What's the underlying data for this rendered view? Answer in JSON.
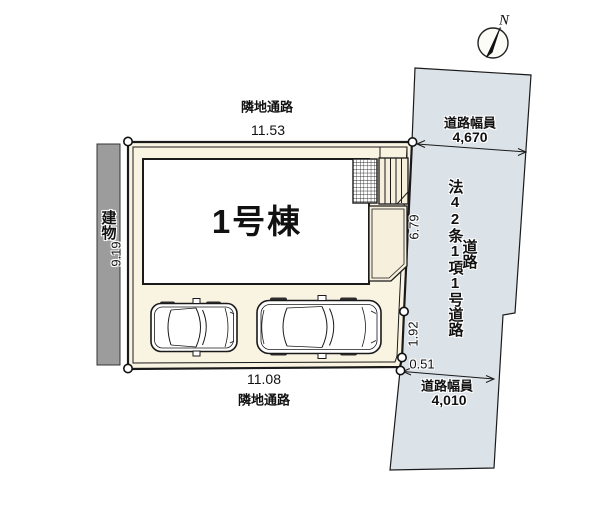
{
  "compass": {
    "label": "N"
  },
  "site": {
    "building_label": "1号棟",
    "passage_top": {
      "label": "隣地通路",
      "dimension": "11.53"
    },
    "passage_bottom": {
      "label": "隣地通路",
      "dimension": "11.08"
    },
    "neighbor_building_label": "建物",
    "dim_left": "9.19",
    "dim_right_upper": "6.79",
    "dim_right_mid": "1.92",
    "dim_right_small": "0.51"
  },
  "road": {
    "designation": "法42条1項1号道路",
    "label": "道路",
    "width_top_caption": "道路幅員",
    "width_top_value": "4,670",
    "width_bottom_caption": "道路幅員",
    "width_bottom_value": "4,010"
  },
  "colors": {
    "road_fill": "#dbe2e8",
    "lot_fill": "#f9f3e1",
    "porch_fill": "#f6efdc",
    "building_fill": "#ffffff",
    "neighbor_building_fill": "#9c9c9c",
    "line": "#1a1a1a"
  }
}
